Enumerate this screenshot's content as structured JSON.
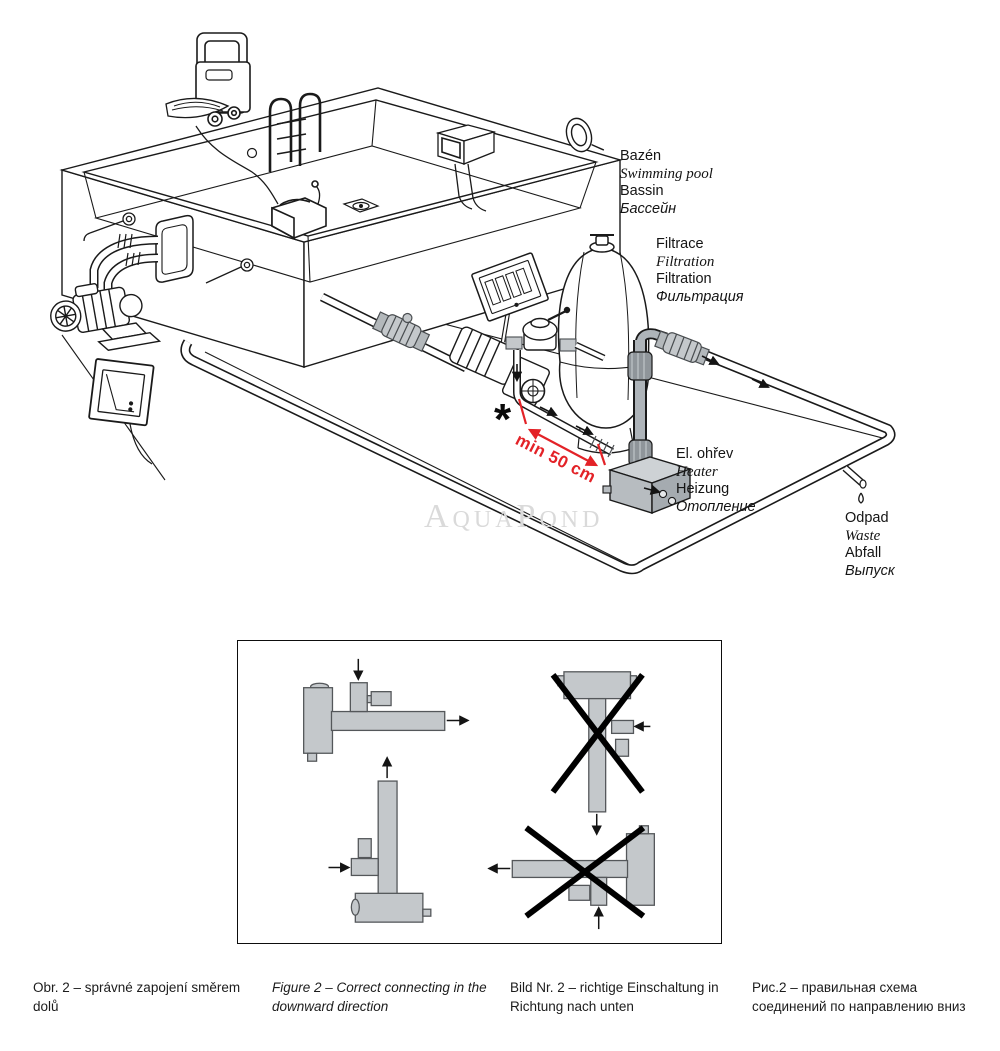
{
  "colors": {
    "line": "#1a1a1a",
    "diagram_gray": "#c4c8cb",
    "heater_pipe_gray": "#a9afb4",
    "accent_red": "#e32227",
    "watermark_gray": "#dadada"
  },
  "watermark": {
    "text": "AquaPond"
  },
  "annotation": {
    "asterisk": "*",
    "min_distance": "min 50 cm"
  },
  "labels": {
    "pool": {
      "lines": [
        "Bazén",
        "Swimming pool",
        "Bassin",
        "Бассейн"
      ]
    },
    "filtration": {
      "lines": [
        "Filtrace",
        "Filtration",
        "Filtration",
        "Фильтрация"
      ]
    },
    "heater": {
      "lines": [
        "El. ohřev",
        "Heater",
        "Heizung",
        "Отопление"
      ]
    },
    "waste": {
      "lines": [
        "Odpad",
        "Waste",
        "Abfall",
        "Выпуск"
      ]
    }
  },
  "captions": {
    "czech": "Obr. 2 – správné zapojení směrem dolů",
    "english": "Figure 2 – Correct connecting in the downward direction",
    "german": "Bild Nr. 2 – richtige Einschaltung in Richtung nach unten",
    "russian": "Рис.2 – правильная схема соединений по направлению вниз"
  }
}
